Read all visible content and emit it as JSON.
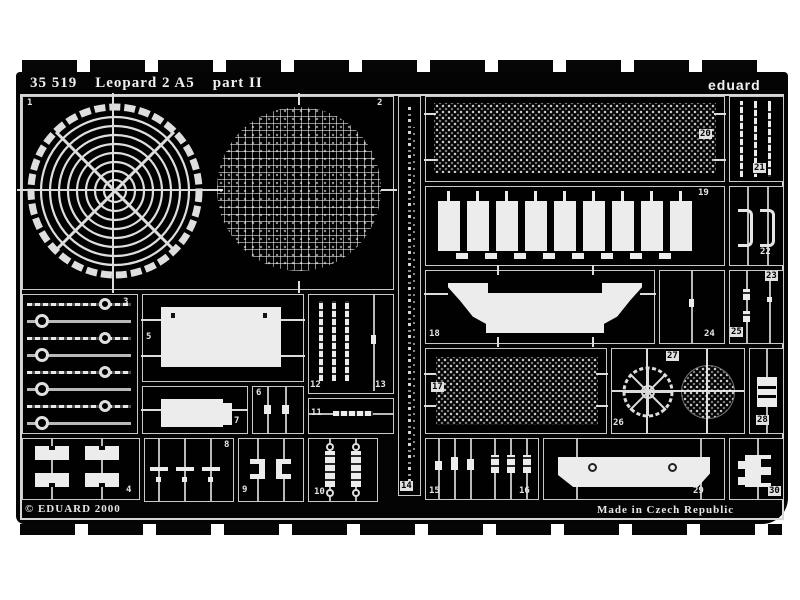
{
  "header": {
    "set_number": "35 519",
    "set_name": "Leopard 2 A5",
    "sheet": "part II",
    "brand": "eduard"
  },
  "footer": {
    "copyright": "© EDUARD 2000",
    "made_in": "Made in Czech Republic"
  },
  "part_numbers": [
    "1",
    "2",
    "3",
    "4",
    "5",
    "6",
    "7",
    "8",
    "9",
    "10",
    "11",
    "12",
    "13",
    "14",
    "15",
    "16",
    "17",
    "18",
    "19",
    "20",
    "21",
    "22",
    "23",
    "24",
    "25",
    "26",
    "27",
    "28",
    "29",
    "30"
  ],
  "colors": {
    "page_background": "#ffffff",
    "photo_background": "#040404",
    "etched_metal": "#ececec",
    "outline": "#d6d6d6"
  }
}
